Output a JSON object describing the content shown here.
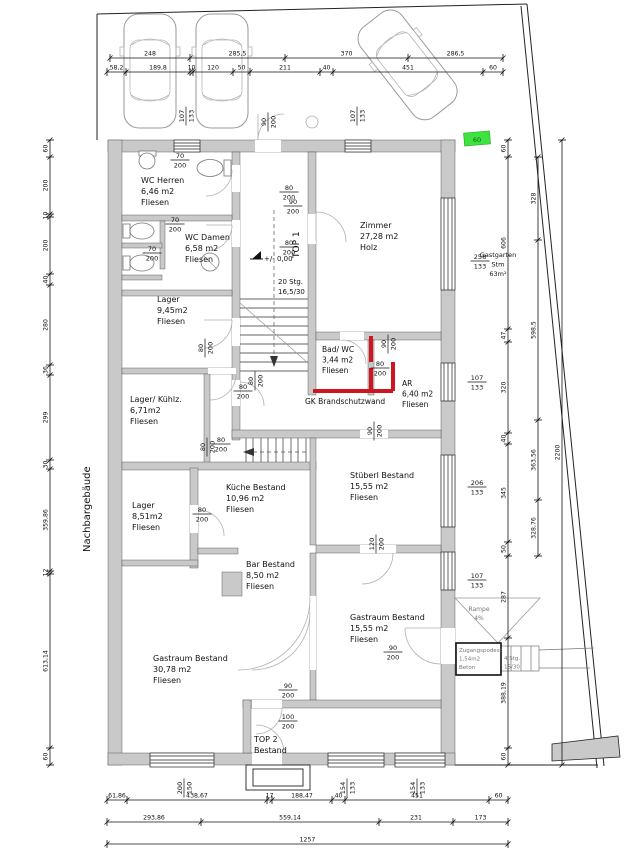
{
  "drawing": {
    "type": "architectural-floor-plan",
    "neighbor_label": "Nachbargebäude",
    "fire_wall_color": "#cf1620",
    "wall_color": "#c9c9c9",
    "highlight_green": "#3fe33f"
  },
  "labels": [
    {
      "n": "room-wc-herren",
      "lines": [
        "WC Herren",
        "6,46 m2",
        "Fliesen"
      ],
      "x": 141,
      "y": 183,
      "s": 8
    },
    {
      "n": "room-wc-damen",
      "lines": [
        "WC Damen",
        "6,58 m2",
        "Fliesen"
      ],
      "x": 185,
      "y": 240,
      "s": 8
    },
    {
      "n": "room-lager-945",
      "lines": [
        "Lager",
        "9,45m2",
        "Fliesen"
      ],
      "x": 157,
      "y": 302,
      "s": 8
    },
    {
      "n": "room-lager-kuehlz",
      "lines": [
        "Lager/ Kühlz.",
        "6,71m2",
        "Fliesen"
      ],
      "x": 130,
      "y": 402,
      "s": 8
    },
    {
      "n": "room-lager-851",
      "lines": [
        "Lager",
        "8,51m2",
        "Fliesen"
      ],
      "x": 132,
      "y": 508,
      "s": 8
    },
    {
      "n": "room-zimmer",
      "lines": [
        "Zimmer",
        "27,28 m2",
        "Holz"
      ],
      "x": 360,
      "y": 228,
      "s": 8
    },
    {
      "n": "room-bad-wc",
      "lines": [
        "Bad/ WC",
        "3,44 m2",
        "Fliesen"
      ],
      "x": 322,
      "y": 352,
      "s": 7.5
    },
    {
      "n": "room-ar",
      "lines": [
        "AR",
        "6,40 m2",
        "Fliesen"
      ],
      "x": 402,
      "y": 386,
      "s": 7.5
    },
    {
      "n": "room-kueche",
      "lines": [
        "Küche Bestand",
        "10,96 m2",
        "Fliesen"
      ],
      "x": 226,
      "y": 490,
      "s": 8
    },
    {
      "n": "room-stueberl",
      "lines": [
        "Stüberl Bestand",
        "15,55 m2",
        "Fliesen"
      ],
      "x": 350,
      "y": 478,
      "s": 8
    },
    {
      "n": "room-bar",
      "lines": [
        "Bar Bestand",
        "8,50 m2",
        "Fliesen"
      ],
      "x": 246,
      "y": 567,
      "s": 8
    },
    {
      "n": "room-gastraum-30",
      "lines": [
        "Gastraum Bestand",
        "30,78 m2",
        "Fliesen"
      ],
      "x": 153,
      "y": 661,
      "s": 8
    },
    {
      "n": "room-gastraum-15",
      "lines": [
        "Gastraum Bestand",
        "15,55 m2",
        "Fliesen"
      ],
      "x": 350,
      "y": 620,
      "s": 8
    },
    {
      "n": "room-top2",
      "lines": [
        "TOP 2",
        "Bestand"
      ],
      "x": 254,
      "y": 742,
      "s": 8
    },
    {
      "n": "gastgarten-label",
      "lines": [
        "Gastgarten",
        "Stm",
        "63m²"
      ],
      "x": 498,
      "y": 257,
      "s": 6.5,
      "anchor": "middle"
    },
    {
      "n": "rampe-label",
      "lines": [
        "Rampe",
        "4%"
      ],
      "x": 479,
      "y": 611,
      "s": 6,
      "anchor": "middle",
      "color": "#777777"
    },
    {
      "n": "podest-label",
      "lines": [
        "Zugangspodest",
        "1,54m2",
        "Beton"
      ],
      "x": 459,
      "y": 652,
      "s": 5.5,
      "color": "#777777"
    },
    {
      "n": "ext-stair-label",
      "lines": [
        "4 Stg.",
        "15/30"
      ],
      "x": 504,
      "y": 660,
      "s": 5.5,
      "color": "#777777"
    },
    {
      "n": "stair-note",
      "lines": [
        "20 Stg.",
        "16,5/30"
      ],
      "x": 278,
      "y": 284,
      "s": 7
    },
    {
      "n": "firewall-label",
      "lines": [
        "GK Brandschutzwand"
      ],
      "x": 305,
      "y": 404,
      "s": 7.5
    },
    {
      "n": "level-label",
      "lines": [
        "+/- 0,00"
      ],
      "x": 264,
      "y": 261,
      "s": 7
    },
    {
      "n": "top1-label",
      "lines": [
        "TOP 1"
      ],
      "x": 299,
      "y": 258,
      "s": 9,
      "rot": -90
    },
    {
      "n": "neighbor-label",
      "lines": [
        "Nachbargebäude"
      ],
      "x": 90,
      "y": 552,
      "s": 10,
      "rot": -90
    },
    {
      "n": "green-marker-text",
      "lines": [
        "60"
      ],
      "x": 477,
      "y": 142,
      "s": 6.5,
      "anchor": "middle",
      "color": "#135e13"
    }
  ],
  "door_dims": [
    [
      "70",
      "200",
      180,
      160,
      "h"
    ],
    [
      "80",
      "200",
      289,
      192,
      "h"
    ],
    [
      "70",
      "200",
      175,
      224,
      "h"
    ],
    [
      "80",
      "200",
      289,
      247,
      "h"
    ],
    [
      "70",
      "200",
      152,
      253,
      "h"
    ],
    [
      "90",
      "200",
      293,
      206,
      "h"
    ],
    [
      "107",
      "133",
      186,
      116,
      "v"
    ],
    [
      "90",
      "200",
      268,
      122,
      "v"
    ],
    [
      "107",
      "133",
      357,
      116,
      "v"
    ],
    [
      "80",
      "200",
      205,
      348,
      "v"
    ],
    [
      "80",
      "200",
      243,
      391,
      "h"
    ],
    [
      "80",
      "200",
      255,
      381,
      "v"
    ],
    [
      "90",
      "200",
      388,
      344,
      "v"
    ],
    [
      "80",
      "200",
      380,
      368,
      "h"
    ],
    [
      "107",
      "133",
      477,
      382,
      "h"
    ],
    [
      "90",
      "200",
      374,
      431,
      "v"
    ],
    [
      "80",
      "200",
      221,
      444,
      "h"
    ],
    [
      "80",
      "200",
      207,
      447,
      "v"
    ],
    [
      "80",
      "200",
      202,
      514,
      "h"
    ],
    [
      "120",
      "200",
      376,
      544,
      "v"
    ],
    [
      "206",
      "133",
      477,
      487,
      "h"
    ],
    [
      "258",
      "133",
      480,
      261,
      "h"
    ],
    [
      "107",
      "133",
      477,
      580,
      "h"
    ],
    [
      "90",
      "200",
      393,
      652,
      "h"
    ],
    [
      "90",
      "200",
      288,
      690,
      "h"
    ],
    [
      "100",
      "200",
      288,
      721,
      "h"
    ],
    [
      "200",
      "150",
      184,
      788,
      "v"
    ],
    [
      "154",
      "133",
      347,
      788,
      "v"
    ],
    [
      "154",
      "133",
      417,
      788,
      "v"
    ]
  ],
  "chains": [
    {
      "o": "h",
      "c": 58,
      "segs": [
        [
          110,
          190,
          "248"
        ],
        [
          190,
          285,
          "285,5"
        ],
        [
          285,
          408,
          "370"
        ],
        [
          408,
          503,
          "286,5"
        ]
      ]
    },
    {
      "o": "h",
      "c": 72,
      "segs": [
        [
          107,
          126,
          "58,2"
        ],
        [
          126,
          190,
          "189,8"
        ],
        [
          190,
          193,
          "10"
        ],
        [
          193,
          233,
          "120"
        ],
        [
          233,
          250,
          "50"
        ],
        [
          250,
          320,
          "211"
        ],
        [
          320,
          333,
          "40"
        ],
        [
          333,
          483,
          "451"
        ],
        [
          483,
          503,
          "60"
        ]
      ]
    },
    {
      "o": "v",
      "c": 50,
      "segs": [
        [
          140,
          157,
          "60"
        ],
        [
          157,
          214,
          "200"
        ],
        [
          214,
          217,
          "10"
        ],
        [
          217,
          274,
          "200"
        ],
        [
          274,
          285,
          "40"
        ],
        [
          285,
          365,
          "280"
        ],
        [
          365,
          375,
          "36"
        ],
        [
          375,
          460,
          "299"
        ],
        [
          460,
          469,
          "30"
        ],
        [
          469,
          571,
          "359,86"
        ],
        [
          571,
          574,
          "12"
        ],
        [
          574,
          748,
          "613,14"
        ],
        [
          748,
          765,
          "60"
        ]
      ]
    },
    {
      "o": "v",
      "c": 508,
      "segs": [
        [
          140,
          157,
          "60"
        ],
        [
          157,
          329,
          "606"
        ],
        [
          329,
          342,
          "47"
        ],
        [
          342,
          433,
          "320"
        ],
        [
          433,
          444,
          "40"
        ],
        [
          444,
          542,
          "345"
        ],
        [
          542,
          556,
          "50"
        ],
        [
          556,
          638,
          "287"
        ],
        [
          638,
          748,
          "388,19"
        ],
        [
          748,
          765,
          "60"
        ]
      ]
    },
    {
      "o": "v",
      "c": 538,
      "segs": [
        [
          157,
          240,
          "328"
        ],
        [
          240,
          420,
          "598,5"
        ],
        [
          420,
          500,
          "363,56"
        ],
        [
          500,
          556,
          "328,76"
        ]
      ]
    },
    {
      "o": "v",
      "c": 562,
      "segs": [
        [
          140,
          765,
          "2200"
        ]
      ]
    },
    {
      "o": "h",
      "c": 800,
      "segs": [
        [
          107,
          127,
          "61,86"
        ],
        [
          127,
          267,
          "438,67"
        ],
        [
          267,
          272,
          "17"
        ],
        [
          272,
          332,
          "188,47"
        ],
        [
          332,
          345,
          "40"
        ],
        [
          345,
          489,
          "451"
        ],
        [
          489,
          508,
          "60"
        ]
      ]
    },
    {
      "o": "h",
      "c": 822,
      "segs": [
        [
          107,
          201,
          "293,86"
        ],
        [
          201,
          379,
          "559,14"
        ],
        [
          379,
          453,
          "231"
        ],
        [
          453,
          508,
          "173"
        ]
      ]
    },
    {
      "o": "h",
      "c": 844,
      "segs": [
        [
          107,
          508,
          "1257"
        ]
      ]
    }
  ]
}
